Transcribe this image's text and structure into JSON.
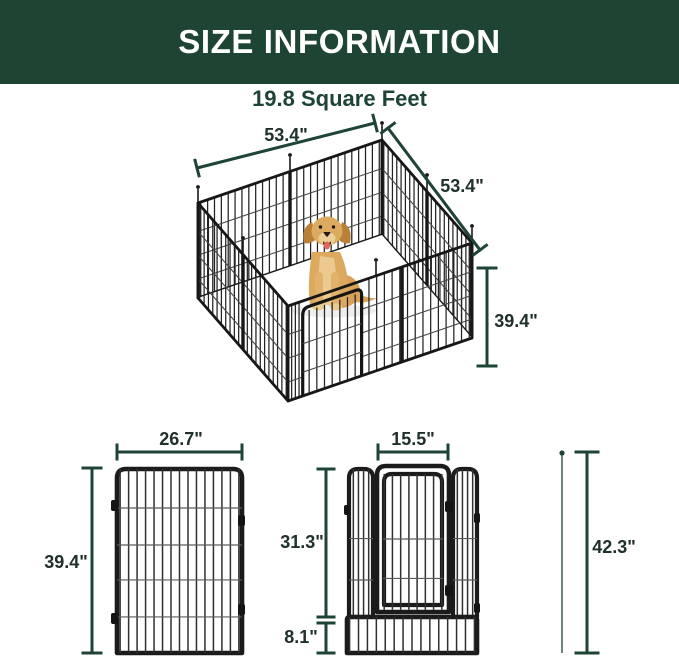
{
  "colors": {
    "header_bg": "#1e4434",
    "accent_green": "#1d4434",
    "text_dark": "#20302a",
    "fence_black": "#1b1b1b",
    "dog_gold": "#dcab60",
    "floor_white": "#ffffff"
  },
  "header": {
    "title": "SIZE INFORMATION"
  },
  "subtitle": {
    "text": "19.8 Square Feet"
  },
  "pen3d": {
    "width_label": "53.4\"",
    "depth_label": "53.4\"",
    "height_label": "39.4\""
  },
  "panel": {
    "width_label": "26.7\"",
    "height_label": "39.4\""
  },
  "door": {
    "width_label": "15.5\"",
    "height_label": "31.3\"",
    "bottom_label": "8.1\"",
    "total_label": "42.3\""
  }
}
